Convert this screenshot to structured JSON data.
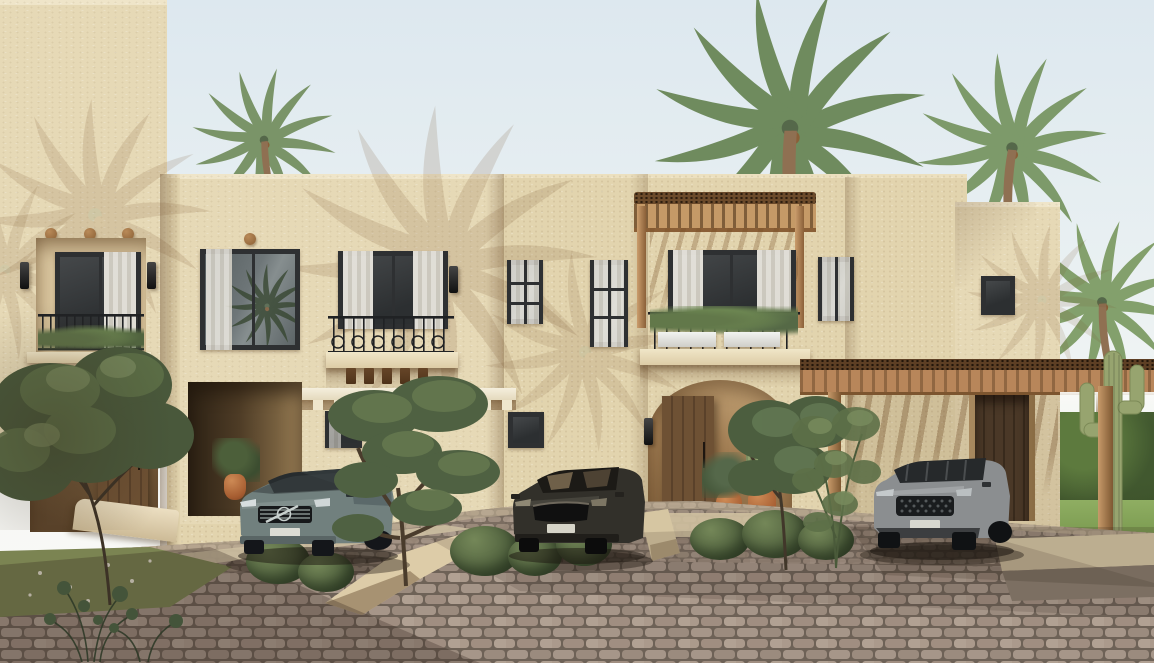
{
  "scene": {
    "label": "3D architectural rendering of a row of sand-colored desert-style two-story townhouses with palm trees, three parked cars and a cobblestone driveway under a pale clear sky",
    "objects": {
      "building_left": "left townhouse with recessed balcony window and arched wooden entry door",
      "building_center": "center townhouse block with juliet balcony, dark-framed windows and white entry canopy",
      "building_pergola": "townhouse unit with wooden pergola over the balcony, planter boxes and arched wooden entry",
      "building_right": "right townhouse unit with wooden carport pergola and dark plank garage door",
      "car_left": "gray-green estate wagon parked facing the street",
      "car_middle": "dark brown sedan parked on the driveway ramp",
      "car_right": "gray SUV parked under the carport pergola",
      "palm_top_middle": "tall palm tree rising behind the central parapet",
      "palm_top_left": "palm tree behind the left parapet",
      "palm_top_right": "palm tree behind the right parapet",
      "palm_right_side": "palm tree at the right side of the buildings",
      "cactus_right": "tall saguaro cactus beside the right palm",
      "tree_left": "leafy green tree in front of the left unit",
      "tree_center": "sculpted multi-canopy tree in the center planting island",
      "tree_unit3": "small leafy tree beside the pergola-unit entry",
      "hedge_right": "green hedge and lawn at the far right",
      "lawn_left": "lawn patch with white wildflowers at lower left",
      "paving": "gray-brown cobblestone driveway with long shadows",
      "balcony_railings": "black wrought-iron juliet balcony railings",
      "wall_sconces": "black wall lantern sconces beside openings"
    },
    "palette": {
      "sky": "#e7eef2",
      "stucco": "#e6d9b6",
      "stucco_shadow": "#c3ab85",
      "window_frame": "#2e3032",
      "glass": "#666e70",
      "curtain": "#ece9e1",
      "door_wood": "#6b4f33",
      "pergola_wood": "#bd8e5d",
      "terracotta": "#b96f41",
      "iron_railing": "#202224",
      "paving": "#a09082",
      "grass": "#7b8452",
      "foliage": "#5b6e48",
      "palm_green": "#7d9668",
      "car_left": "#71807e",
      "car_middle": "#32302a",
      "car_right": "#8b8e90"
    }
  }
}
